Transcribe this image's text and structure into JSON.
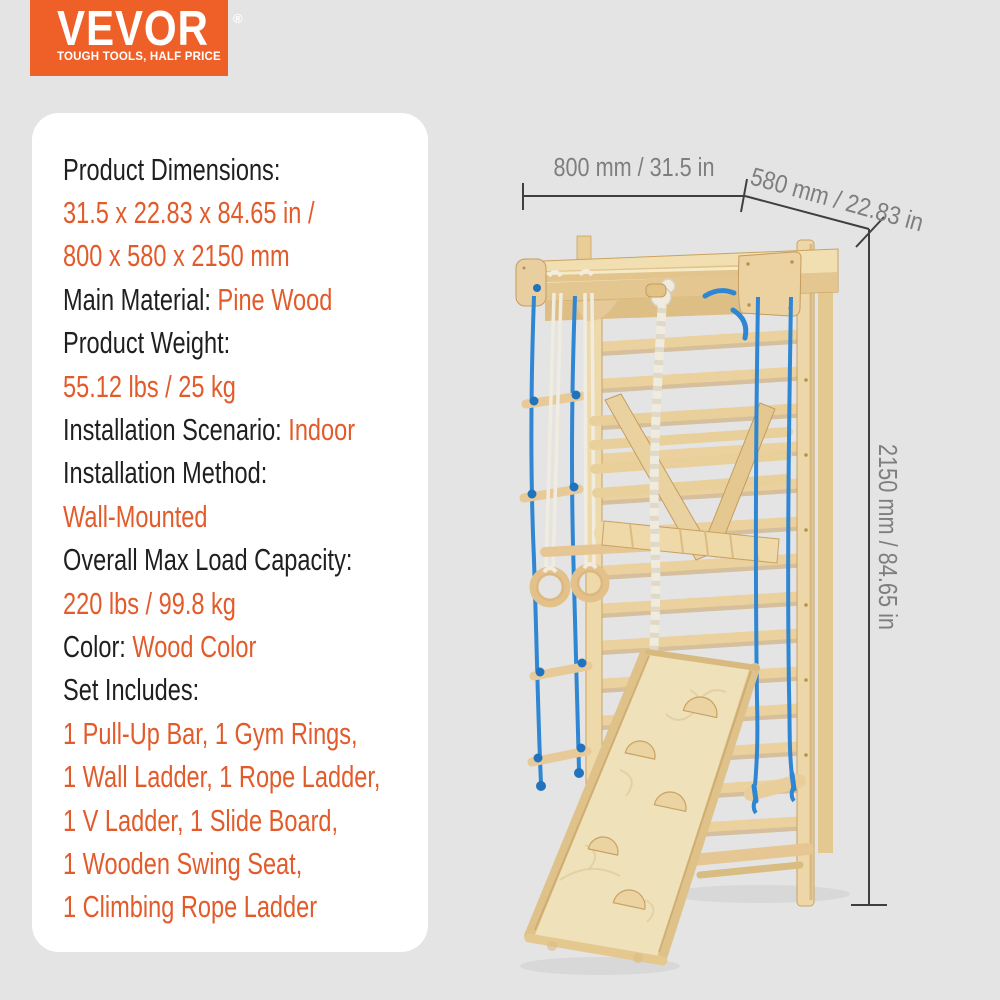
{
  "logo": {
    "brand": "VEVOR",
    "registered": "®",
    "tagline": "TOUGH TOOLS, HALF PRICE",
    "bg_color": "#EE6028"
  },
  "specs": [
    {
      "black": "Product Dimensions:",
      "orange": ""
    },
    {
      "black": "",
      "orange": "31.5 x 22.83 x 84.65 in /"
    },
    {
      "black": "",
      "orange": "800 x 580 x 2150 mm"
    },
    {
      "black": "Main Material: ",
      "orange": "Pine Wood"
    },
    {
      "black": "Product Weight:",
      "orange": ""
    },
    {
      "black": "",
      "orange": "55.12 lbs / 25 kg"
    },
    {
      "black": "Installation Scenario: ",
      "orange": "Indoor"
    },
    {
      "black": "Installation Method:",
      "orange": ""
    },
    {
      "black": "",
      "orange": "Wall-Mounted"
    },
    {
      "black": "Overall Max Load Capacity:",
      "orange": ""
    },
    {
      "black": "",
      "orange": "220 lbs / 99.8 kg"
    },
    {
      "black": "Color: ",
      "orange": "Wood Color"
    },
    {
      "black": "Set Includes:",
      "orange": ""
    },
    {
      "black": "",
      "orange": "1 Pull-Up Bar, 1 Gym Rings,"
    },
    {
      "black": "",
      "orange": "1 Wall Ladder, 1 Rope Ladder,"
    },
    {
      "black": "",
      "orange": "1 V Ladder, 1 Slide Board,"
    },
    {
      "black": "",
      "orange": "1 Wooden Swing Seat,"
    },
    {
      "black": "",
      "orange": "1 Climbing Rope Ladder"
    }
  ],
  "dimensions": {
    "width": "800 mm / 31.5 in",
    "depth": "580 mm / 22.83 in",
    "height": "2150 mm / 84.65 in"
  },
  "colors": {
    "background": "#E4E4E4",
    "panel": "#FFFFFF",
    "logo_orange": "#EE6028",
    "text_orange": "#E25B2B",
    "text_black": "#1F1F1F",
    "rope_blue": "#2F86D2",
    "wood_light": "#F1DFB2",
    "wood_dark": "#C9A262",
    "dimension_line": "#3F3F3F",
    "dimension_label_gray": "#7E7E7E"
  }
}
